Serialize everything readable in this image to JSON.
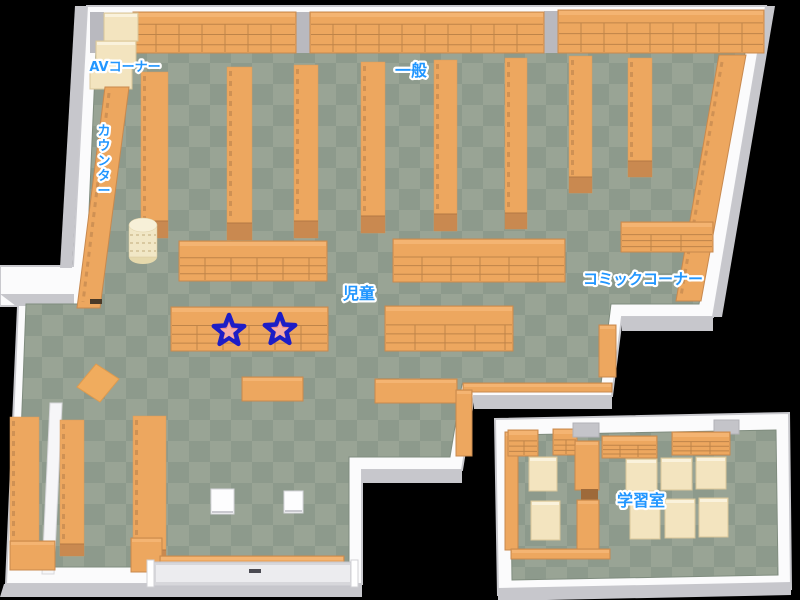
{
  "map": {
    "canvas": {
      "w": 800,
      "h": 600
    },
    "colors": {
      "background": "#000000",
      "wall_white": "#FBFBFC",
      "wall_stroke": "#C9C9CE",
      "wall_gray": "#C7C7CC",
      "floor_dark": "#8D9A8C",
      "floor_light": "#99A495",
      "floor_stroke": "#7F8C7E",
      "shelf_orange": "#EDA75F",
      "shelf_edge": "#C8894E",
      "shelf_line": "#BE8449",
      "shelf_front": "#C98950",
      "shelf_highlight": "#F4B472",
      "shelf_texture": "#CF9154",
      "cream": "#F3E4BF",
      "cream_edge": "#D9C69A",
      "pillar_gray": "#B9B9BF",
      "door_gray": "#C4C4C9",
      "label_blue": "#2196FF",
      "label_outline": "#FFFFFF",
      "star_fill": "#F2908A",
      "star_inner": "#F6ACA5",
      "star_stroke": "#1D1DC6"
    },
    "rooms": {
      "main": {
        "outer": "87,6 766,6 713,317 622,317 612,396 474,396 462,470 362,470 362,584 6,584 18,306 0,306 0,266 73,266",
        "floor": "101,20 751,20 699,304 611,304 601,384 462,384 450,457 349,457 349,567 16,567 26,304 85,304 97,26"
      },
      "study": {
        "outer": "495,419 789,413 791,589 498,595",
        "floor": "510,435 776,430 778,575 512,580"
      }
    },
    "gray_faces": [
      {
        "points": "75,6 87,6 72,268 60,268"
      },
      {
        "points": "766,6 775,6 722,317 713,317"
      },
      {
        "points": "622,317 713,317 713,331 622,331"
      },
      {
        "points": "474,396 612,396 612,409 474,409"
      },
      {
        "points": "362,470 462,470 462,483 362,483"
      },
      {
        "points": "4,584 362,584 362,597 0,597"
      },
      {
        "points": "0,294 74,294 74,306 16,306"
      },
      {
        "points": "498,588 791,582 791,595 498,601"
      }
    ],
    "furniture": [
      {
        "t": "pillar",
        "name": "wall-pillar",
        "x": 90,
        "y": 12,
        "w": 14,
        "h": 41
      },
      {
        "t": "pillar",
        "name": "wall-pillar",
        "x": 296,
        "y": 12,
        "w": 14,
        "h": 41
      },
      {
        "t": "pillar",
        "name": "wall-pillar",
        "x": 544,
        "y": 11,
        "w": 14,
        "h": 42
      },
      {
        "t": "grid",
        "name": "wall-bookshelf",
        "x": 133,
        "y": 12,
        "w": 163,
        "h": 41,
        "cell": 23,
        "rows": [
          0.3,
          0.55,
          0.8
        ]
      },
      {
        "t": "grid",
        "name": "wall-bookshelf",
        "x": 310,
        "y": 12,
        "w": 234,
        "h": 41,
        "cell": 23,
        "rows": [
          0.3,
          0.55,
          0.8
        ]
      },
      {
        "t": "grid",
        "name": "wall-bookshelf",
        "x": 558,
        "y": 10,
        "w": 206,
        "h": 43,
        "cell": 23,
        "rows": [
          0.3,
          0.55,
          0.8
        ]
      },
      {
        "t": "cream",
        "name": "av-corner-shelf",
        "x": 104,
        "y": 13,
        "w": 34,
        "h": 28
      },
      {
        "t": "cream",
        "name": "av-corner-shelf",
        "x": 96,
        "y": 41,
        "w": 40,
        "h": 24
      },
      {
        "t": "cream",
        "name": "av-corner-shelf",
        "x": 90,
        "y": 65,
        "w": 42,
        "h": 24
      },
      {
        "t": "tall",
        "name": "bookshelf-row",
        "x": 141,
        "y": 72,
        "w": 27,
        "yend": 238,
        "front": 17
      },
      {
        "t": "tall",
        "name": "bookshelf-row",
        "x": 227,
        "y": 67,
        "w": 25,
        "yend": 240,
        "front": 17
      },
      {
        "t": "tall",
        "name": "bookshelf-row",
        "x": 294,
        "y": 65,
        "w": 24,
        "yend": 238,
        "front": 17
      },
      {
        "t": "tall",
        "name": "bookshelf-row",
        "x": 361,
        "y": 62,
        "w": 24,
        "yend": 233,
        "front": 17
      },
      {
        "t": "tall",
        "name": "bookshelf-row",
        "x": 434,
        "y": 60,
        "w": 23,
        "yend": 231,
        "front": 17
      },
      {
        "t": "tall",
        "name": "bookshelf-row",
        "x": 505,
        "y": 58,
        "w": 22,
        "yend": 229,
        "front": 16
      },
      {
        "t": "tall",
        "name": "bookshelf-row",
        "x": 569,
        "y": 56,
        "w": 23,
        "yend": 193,
        "front": 16
      },
      {
        "t": "tall",
        "name": "bookshelf-row",
        "x": 628,
        "y": 58,
        "w": 24,
        "yend": 177,
        "front": 16
      },
      {
        "t": "poly",
        "name": "bookshelf-right-wall",
        "points": "719,55 746,55 701,301 676,301",
        "dash": [
          722,
          62,
          681,
          296
        ]
      },
      {
        "t": "poly",
        "name": "counter-desk",
        "points": "105,87 129,87 100,308 77,308",
        "dash": [
          109,
          93,
          83,
          302
        ]
      },
      {
        "t": "darkmark",
        "name": "counter-slot",
        "x": 90,
        "y": 299,
        "w": 12,
        "h": 5,
        "fill": "#4A3A28"
      },
      {
        "t": "cyl",
        "name": "round-rack",
        "cx": 143,
        "cy": 225
      },
      {
        "t": "grid",
        "name": "low-shelf",
        "x": 179,
        "y": 241,
        "w": 148,
        "h": 40,
        "cell": 26
      },
      {
        "t": "grid",
        "name": "low-shelf-starred",
        "x": 171,
        "y": 307,
        "w": 157,
        "h": 44,
        "cell": 26
      },
      {
        "t": "grid",
        "name": "low-shelf",
        "x": 393,
        "y": 239,
        "w": 172,
        "h": 43,
        "cell": 29
      },
      {
        "t": "grid",
        "name": "low-shelf",
        "x": 385,
        "y": 306,
        "w": 128,
        "h": 45,
        "cell": 30
      },
      {
        "t": "plain",
        "name": "low-shelf",
        "x": 242,
        "y": 377,
        "w": 61,
        "h": 24
      },
      {
        "t": "plain",
        "name": "low-shelf",
        "x": 375,
        "y": 379,
        "w": 82,
        "h": 24
      },
      {
        "t": "grid",
        "name": "comic-shelf",
        "x": 621,
        "y": 222,
        "w": 92,
        "h": 30,
        "cell": 30
      },
      {
        "t": "plain",
        "name": "comic-shelf",
        "x": 599,
        "y": 325,
        "w": 17,
        "h": 52
      },
      {
        "t": "plain",
        "name": "wall-shelf-strip",
        "x": 463,
        "y": 383,
        "w": 149,
        "h": 9
      },
      {
        "t": "plain",
        "name": "wall-shelf",
        "x": 456,
        "y": 390,
        "w": 16,
        "h": 66
      },
      {
        "t": "tall",
        "name": "bookshelf-row",
        "x": 10,
        "y": 417,
        "w": 29,
        "yend": 560,
        "front": 13
      },
      {
        "t": "divider",
        "name": "divider-wall",
        "points": "50,403 62,403 54,574 42,574"
      },
      {
        "t": "tall",
        "name": "bookshelf-row",
        "x": 60,
        "y": 420,
        "w": 24,
        "yend": 556,
        "front": 12
      },
      {
        "t": "tall",
        "name": "bookshelf-row",
        "x": 133,
        "y": 416,
        "w": 33,
        "yend": 563,
        "front": 13
      },
      {
        "t": "mat",
        "name": "floor-mat",
        "points": "96,364 119,379 100,402 77,387"
      },
      {
        "t": "plain",
        "name": "corner-shelf",
        "x": 10,
        "y": 541,
        "w": 45,
        "h": 29
      },
      {
        "t": "plain",
        "name": "corner-shelf",
        "x": 131,
        "y": 538,
        "w": 31,
        "h": 34
      },
      {
        "t": "plain",
        "name": "baseboard-shelf",
        "x": 160,
        "y": 556,
        "w": 184,
        "h": 8
      },
      {
        "t": "whitetable",
        "name": "small-table",
        "x": 211,
        "y": 489,
        "w": 23,
        "h": 25
      },
      {
        "t": "whitetable",
        "name": "small-table",
        "x": 284,
        "y": 491,
        "w": 19,
        "h": 22
      },
      {
        "t": "plain",
        "name": "study-wall-shelf",
        "x": 505,
        "y": 432,
        "w": 13,
        "h": 118
      },
      {
        "t": "grid",
        "name": "study-shelf",
        "x": 508,
        "y": 430,
        "w": 30,
        "h": 26,
        "cell": 16
      },
      {
        "t": "grid",
        "name": "study-shelf",
        "x": 553,
        "y": 429,
        "w": 24,
        "h": 26,
        "cell": 13
      },
      {
        "t": "door",
        "name": "study-doorway",
        "x": 573,
        "y": 423,
        "w": 26,
        "h": 14
      },
      {
        "t": "door",
        "name": "study-doorway",
        "x": 714,
        "y": 420,
        "w": 25,
        "h": 14
      },
      {
        "t": "cream",
        "name": "study-table",
        "x": 529,
        "y": 457,
        "w": 28,
        "h": 34
      },
      {
        "t": "cream",
        "name": "study-table",
        "x": 531,
        "y": 501,
        "w": 29,
        "h": 39
      },
      {
        "t": "plain",
        "name": "study-divider-shelf",
        "x": 575,
        "y": 441,
        "w": 24,
        "h": 49
      },
      {
        "t": "darkmark",
        "name": "study-divider-gap",
        "x": 581,
        "y": 489,
        "w": 17,
        "h": 12,
        "fill": "#9E6A3A"
      },
      {
        "t": "plain",
        "name": "study-divider-shelf",
        "x": 577,
        "y": 500,
        "w": 22,
        "h": 53
      },
      {
        "t": "grid",
        "name": "study-shelf",
        "x": 602,
        "y": 436,
        "w": 55,
        "h": 22,
        "cell": 18
      },
      {
        "t": "grid",
        "name": "study-shelf",
        "x": 672,
        "y": 432,
        "w": 58,
        "h": 23,
        "cell": 19
      },
      {
        "t": "cream",
        "name": "study-table",
        "x": 626,
        "y": 459,
        "w": 31,
        "h": 32
      },
      {
        "t": "cream",
        "name": "study-table",
        "x": 661,
        "y": 458,
        "w": 31,
        "h": 32
      },
      {
        "t": "cream",
        "name": "study-table",
        "x": 696,
        "y": 457,
        "w": 30,
        "h": 32
      },
      {
        "t": "cream",
        "name": "study-table",
        "x": 630,
        "y": 500,
        "w": 30,
        "h": 39
      },
      {
        "t": "cream",
        "name": "study-table",
        "x": 665,
        "y": 499,
        "w": 30,
        "h": 39
      },
      {
        "t": "cream",
        "name": "study-table",
        "x": 699,
        "y": 498,
        "w": 29,
        "h": 39
      },
      {
        "t": "plain",
        "name": "study-baseboard-shelf",
        "x": 511,
        "y": 549,
        "w": 99,
        "h": 10
      }
    ],
    "entrance": {
      "x": 150,
      "y": 562,
      "w": 206,
      "h": 24,
      "jamb1": 147,
      "jamb2": 351,
      "handle_x": 249
    },
    "labels": [
      {
        "id": "av-corner",
        "text": "AVコーナー",
        "x": 125,
        "y": 71,
        "size": 13,
        "vertical": false
      },
      {
        "id": "counter",
        "text": "カウンター",
        "x": 104,
        "y": 135,
        "size": 13,
        "vertical": true
      },
      {
        "id": "general",
        "text": "一般",
        "x": 411,
        "y": 76,
        "size": 16,
        "vertical": false
      },
      {
        "id": "children",
        "text": "児童",
        "x": 359,
        "y": 299,
        "size": 16,
        "vertical": false
      },
      {
        "id": "comic-corner",
        "text": "コミックコーナー",
        "x": 643,
        "y": 284,
        "size": 15,
        "vertical": false
      },
      {
        "id": "study-room",
        "text": "学習室",
        "x": 641,
        "y": 506,
        "size": 16,
        "vertical": false
      }
    ],
    "stars": [
      {
        "x": 229,
        "y": 331
      },
      {
        "x": 280,
        "y": 330
      }
    ]
  }
}
